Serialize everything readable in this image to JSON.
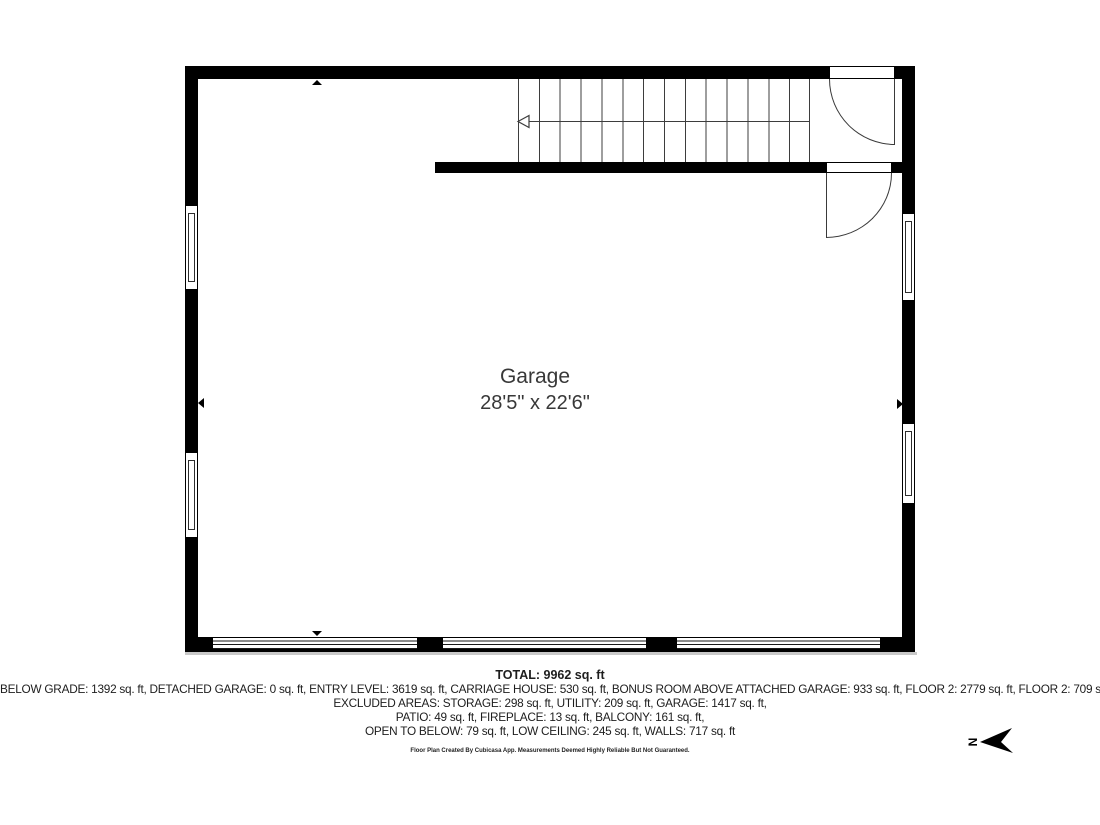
{
  "plan": {
    "room_label": {
      "name": "Garage",
      "dimensions": "28'5\" x 22'6\""
    },
    "compass": {
      "north_label": "N"
    }
  },
  "summary": {
    "total": "TOTAL: 9962 sq. ft",
    "lines": [
      "BELOW GRADE: 1392 sq. ft, DETACHED GARAGE: 0 sq. ft, ENTRY LEVEL: 3619 sq. ft, CARRIAGE HOUSE: 530 sq. ft, BONUS ROOM ABOVE ATTACHED GARAGE: 933 sq. ft, FLOOR 2: 2779 sq. ft, FLOOR 2: 709 sq. ft",
      "EXCLUDED AREAS: STORAGE: 298 sq. ft, UTILITY: 209 sq. ft, GARAGE: 1417 sq. ft,",
      "PATIO: 49 sq. ft, FIREPLACE: 13 sq. ft, BALCONY: 161 sq. ft,",
      "OPEN TO BELOW: 79 sq. ft, LOW CEILING: 245 sq. ft, WALLS: 717 sq. ft"
    ],
    "disclaimer": "Floor Plan Created By Cubicasa App. Measurements Deemed Highly Reliable But Not Guaranteed."
  },
  "colors": {
    "wall": "#000000",
    "shadow": "#c9c9c9",
    "text": "#1d1d1d"
  }
}
